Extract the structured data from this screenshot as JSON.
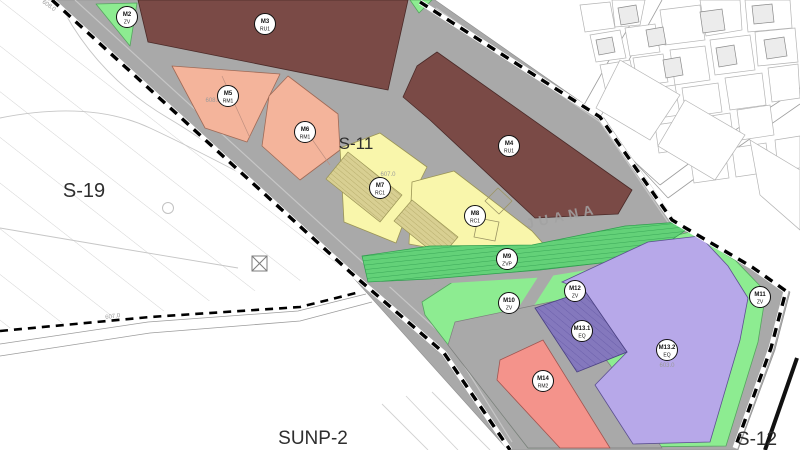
{
  "map": {
    "title": "urban zoning plan sheet",
    "sector_labels": [
      {
        "id": "s-19",
        "text": "S-19",
        "x": 84,
        "y": 197,
        "size": 20,
        "rotate": 0
      },
      {
        "id": "s-11",
        "text": "S-11",
        "x": 356,
        "y": 149,
        "size": 17,
        "rotate": 0
      },
      {
        "id": "sunp-2",
        "text": "SUNP-2",
        "x": 313,
        "y": 444,
        "size": 19,
        "rotate": 0
      },
      {
        "id": "s-12",
        "text": "S-12",
        "x": 757,
        "y": 445,
        "size": 19,
        "rotate": 0
      }
    ],
    "street_labels": [
      {
        "id": "juana",
        "text": "JUANA",
        "x": 563,
        "y": 221,
        "size": 14,
        "rotate": -12
      }
    ],
    "elevation_marks": [
      {
        "text": "608.0",
        "x": 48,
        "y": 7,
        "rotate": 36
      },
      {
        "text": "608.0",
        "x": 213,
        "y": 102,
        "rotate": 0
      },
      {
        "text": "607.0",
        "x": 388,
        "y": 176,
        "rotate": 0
      },
      {
        "text": "603.0",
        "x": 667,
        "y": 367,
        "rotate": 0
      },
      {
        "text": "607.0",
        "x": 113,
        "y": 318,
        "rotate": -8
      }
    ],
    "parcels": [
      {
        "name": "M2",
        "code": "ZV",
        "zone": "ZV",
        "x": 127,
        "y": 17
      },
      {
        "name": "M3",
        "code": "RU1",
        "zone": "RU",
        "x": 265,
        "y": 24
      },
      {
        "name": "M4",
        "code": "RU1",
        "zone": "RU",
        "x": 509,
        "y": 146
      },
      {
        "name": "M5",
        "code": "RM1",
        "zone": "RM",
        "x": 228,
        "y": 96
      },
      {
        "name": "M6",
        "code": "RM1",
        "zone": "RM",
        "x": 305,
        "y": 132
      },
      {
        "name": "M7",
        "code": "RC1",
        "zone": "RC",
        "x": 380,
        "y": 188
      },
      {
        "name": "M8",
        "code": "RC1",
        "zone": "RC",
        "x": 475,
        "y": 216
      },
      {
        "name": "M9",
        "code": "ZVP",
        "zone": "ZVP",
        "x": 507,
        "y": 259
      },
      {
        "name": "M10",
        "code": "ZV",
        "zone": "ZV",
        "x": 509,
        "y": 303
      },
      {
        "name": "M11",
        "code": "ZV",
        "zone": "ZV",
        "x": 760,
        "y": 297
      },
      {
        "name": "M12",
        "code": "ZV",
        "zone": "ZV",
        "x": 575,
        "y": 291
      },
      {
        "name": "M13.1",
        "code": "EQ",
        "zone": "EQ1",
        "x": 582,
        "y": 331
      },
      {
        "name": "M13.2",
        "code": "EQ",
        "zone": "EQ2",
        "x": 667,
        "y": 350
      },
      {
        "name": "M14",
        "code": "RM2",
        "zone": "RM2",
        "x": 543,
        "y": 381
      }
    ],
    "zone_colors": {
      "ZV": "#8dec91",
      "ZVP": "#63d178",
      "RU": "#7a4a46",
      "RM": "#f4b49b",
      "RC": "#f9f6ab",
      "EQ1": "#8478bd",
      "EQ2": "#b7a8e9",
      "RM2": "#f4938b",
      "road": "#a9a9a9",
      "boundary": "#000000"
    }
  }
}
